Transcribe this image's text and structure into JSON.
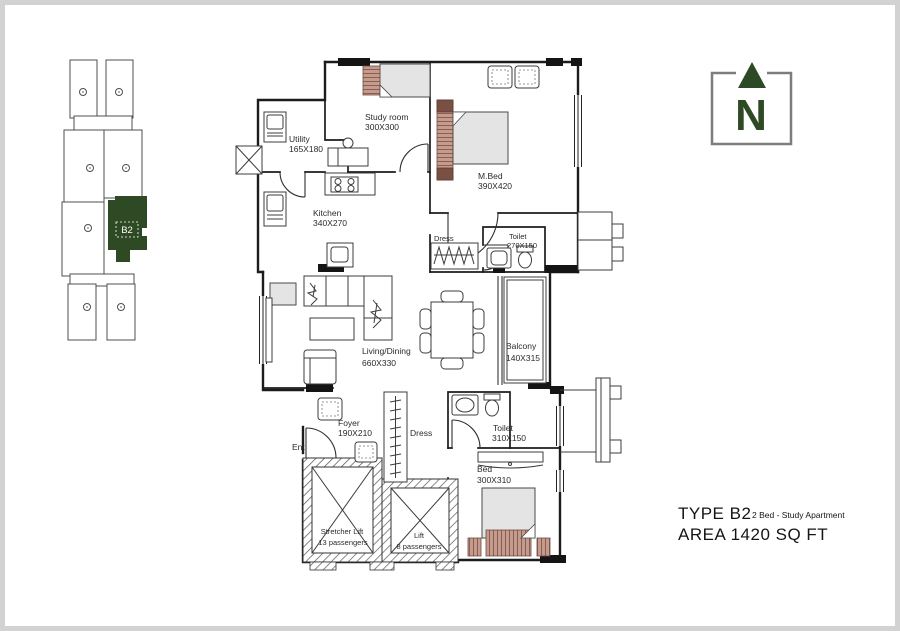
{
  "title_block": {
    "type_label": "TYPE  B2",
    "subtitle": "2 Bed - Study Apartment",
    "area_label": "AREA 1420 SQ FT"
  },
  "north_indicator": {
    "label": "N"
  },
  "key_plan": {
    "unit_label": "B2"
  },
  "colors": {
    "accent_green": "#2d4a24",
    "wall_black": "#1c1c1c",
    "wardrobe_tan": "#c59b8e",
    "wardrobe_brown": "#8a5d52",
    "furniture_gray": "#e4e4e4"
  },
  "rooms": {
    "study": {
      "name": "Study room",
      "dims": "300X300"
    },
    "utility": {
      "name": "Utility",
      "dims": "165X180"
    },
    "kitchen": {
      "name": "Kitchen",
      "dims": "340X270"
    },
    "master_bed": {
      "name": "M.Bed",
      "dims": "390X420"
    },
    "dress_master": {
      "name": "Dress"
    },
    "toilet_master": {
      "name": "Toilet",
      "dims": "270X150"
    },
    "living_dining": {
      "name": "Living/Dining",
      "dims": "660X330"
    },
    "balcony": {
      "name": "Balcony",
      "dims": "140X315"
    },
    "foyer": {
      "name": "Foyer",
      "dims": "190X210"
    },
    "entry": {
      "name": "Ent"
    },
    "dress_bed2": {
      "name": "Dress"
    },
    "toilet_bed2": {
      "name": "Toilet",
      "dims": "310X150"
    },
    "bed2": {
      "name": "Bed",
      "dims": "300X310"
    },
    "stretcher_lift": {
      "name": "Stretcher Lift",
      "capacity": "13 passengers"
    },
    "lift": {
      "name": "Lift",
      "capacity": "8 passengers"
    }
  }
}
